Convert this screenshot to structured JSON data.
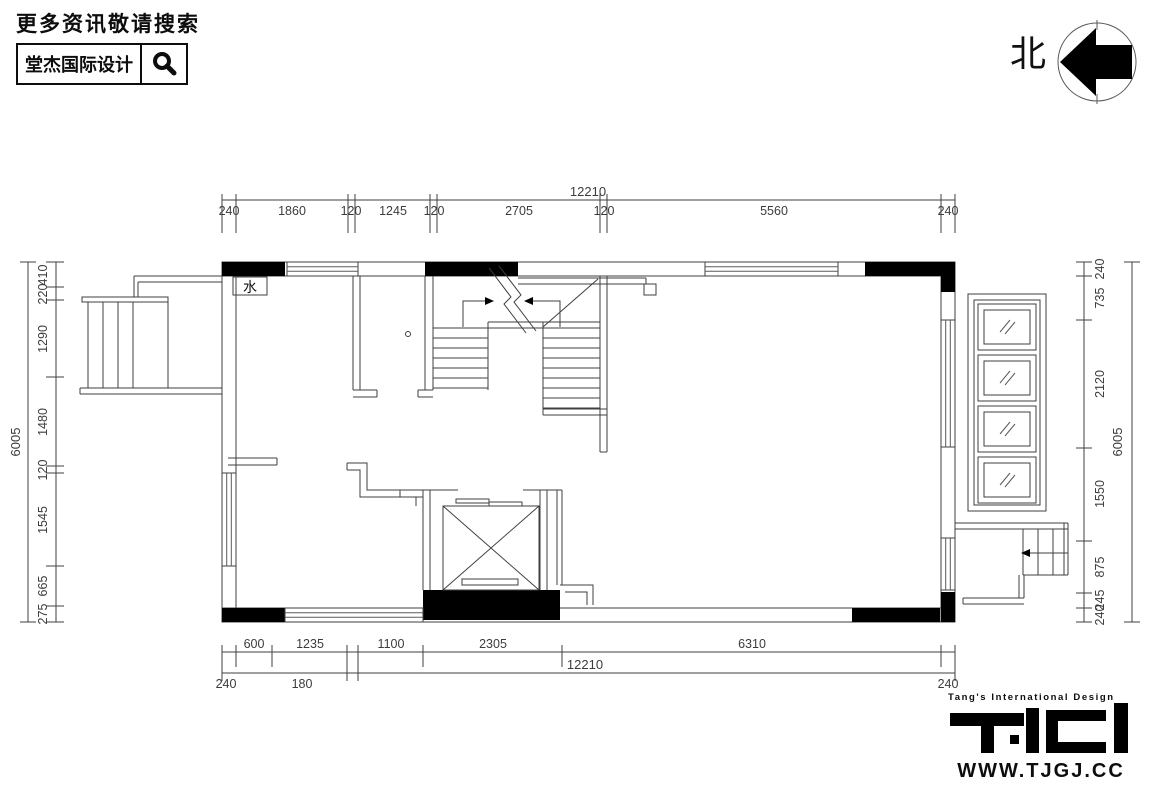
{
  "header": {
    "search_prompt": "更多资讯敬请搜索",
    "brand_name": "堂杰国际设计"
  },
  "north_indicator": {
    "label": "北"
  },
  "plan": {
    "water_label": "水",
    "dimensions": {
      "top": {
        "total": "12210",
        "segments": [
          "240",
          "1860",
          "120",
          "1245",
          "120",
          "2705",
          "120",
          "5560",
          "240"
        ]
      },
      "bottom": {
        "total": "12210",
        "segments_row1": [
          "600",
          "1235",
          "1100",
          "2305",
          "6310"
        ],
        "segments_row2": [
          "240",
          "180",
          "240"
        ]
      },
      "left": {
        "total": "6005",
        "segments": [
          "410",
          "220",
          "1290",
          "1480",
          "120",
          "1545",
          "665",
          "275"
        ]
      },
      "right": {
        "total": "6005",
        "segments": [
          "240",
          "735",
          "2120",
          "1550",
          "875",
          "245",
          "240"
        ]
      }
    }
  },
  "footer": {
    "tagline": "Tang's International Design",
    "logo_alt": "TID",
    "website": "WWW.TJGJ.CC"
  },
  "colors": {
    "ink": "#000000",
    "line": "#3f3f3f",
    "paper": "#ffffff"
  }
}
